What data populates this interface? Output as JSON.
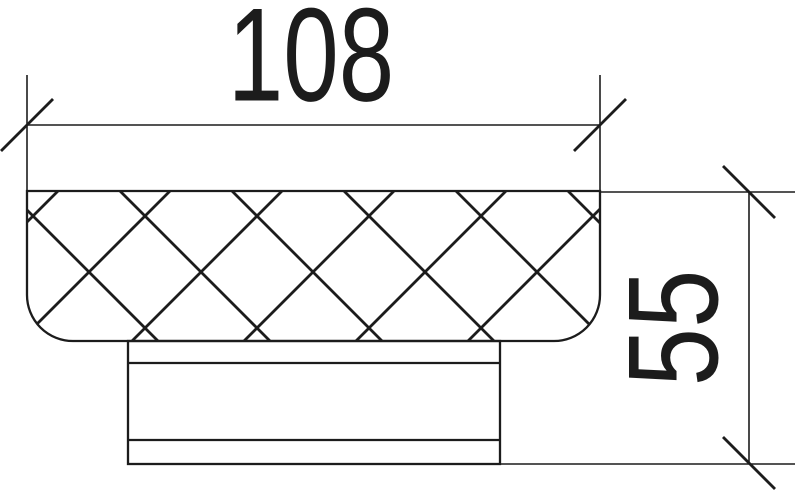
{
  "drawing": {
    "kind": "technical-dimension-drawing",
    "part_name": "knurled-knob-side-profile",
    "background_color": "#ffffff",
    "line_color": "#1c1c1c",
    "dimensions": {
      "width": {
        "label": "108"
      },
      "height": {
        "label": "55"
      }
    }
  }
}
